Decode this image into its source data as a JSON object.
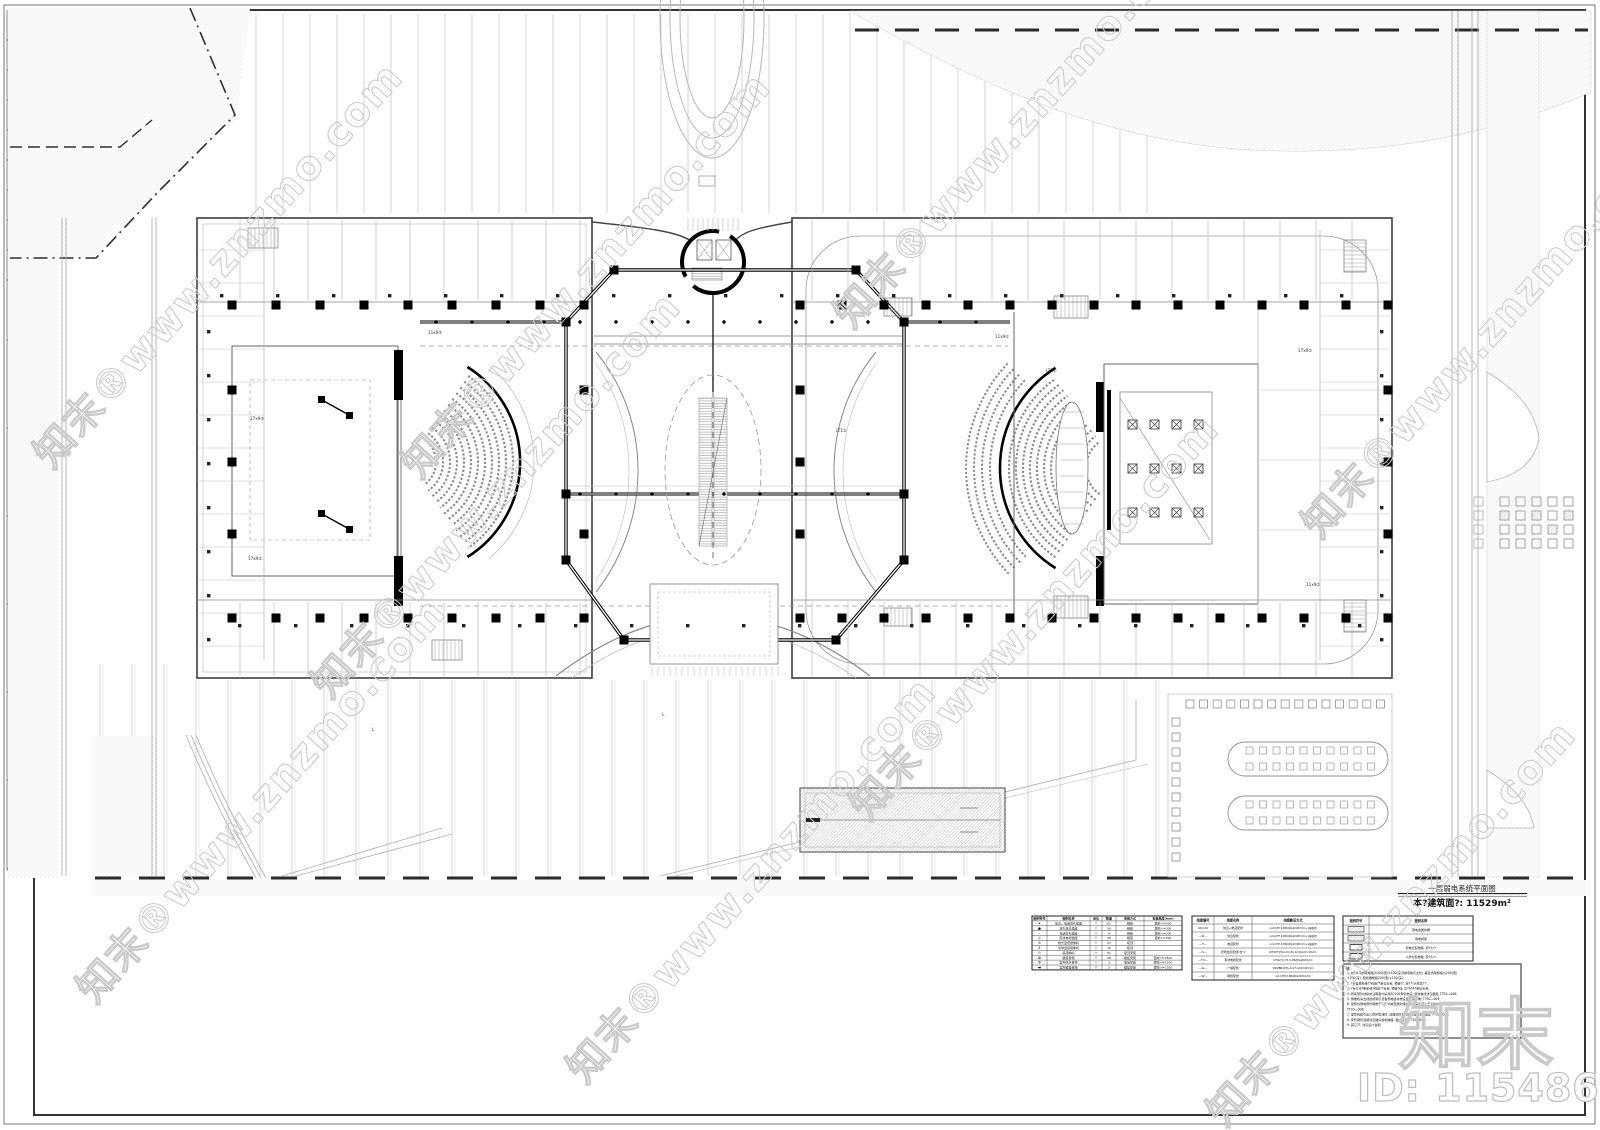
{
  "watermark": {
    "tile_text": "知末®www.znzmo.com",
    "logo_text": "知末",
    "id_text": "ID: 1154862728",
    "color": "#c9c9c9"
  },
  "titleblock": {
    "title": "一层弱电系统平面图",
    "area_label": "本?建筑面?: 11529m²"
  },
  "legend_table": {
    "headers": [
      "图例符号",
      "图例名称",
      "单位",
      "数量",
      "安装方式",
      "安装高度(mm)"
    ],
    "rows": [
      {
        "sym": "✦",
        "name": "信息、电话双孔插座",
        "unit": "个",
        "qty": "61",
        "mount": "暗装",
        "height": "距地 H=300"
      },
      {
        "sym": "●",
        "name": "双孔信息插座",
        "unit": "个",
        "qty": "56",
        "mount": "暗装",
        "height": "距地 H=300"
      },
      {
        "sym": "·",
        "name": "电话双孔插座",
        "unit": "个",
        "qty": "4",
        "mount": "暗装",
        "height": "距地 H=300"
      },
      {
        "sym": "◎",
        "name": "有线电视插座",
        "unit": "个",
        "qty": "28",
        "mount": "暗装",
        "height": "距地 H=300"
      },
      {
        "sym": "⊘",
        "name": "枪式监控摄像机",
        "unit": "个",
        "qty": "21",
        "mount": "吸顶",
        "height": ""
      },
      {
        "sym": "♁",
        "name": "半球监控摄像机",
        "unit": "个",
        "qty": "10",
        "mount": "吸顶",
        "height": ""
      },
      {
        "sym": "⊙",
        "name": "吸顶喇叭",
        "unit": "个",
        "qty": "51",
        "mount": "吸顶安装",
        "height": ""
      },
      {
        "sym": "⊠",
        "name": "壁挂音箱",
        "unit": "个",
        "qty": "28",
        "mount": "壁挂安装",
        "height": "距地 H=2500"
      },
      {
        "sym": "Φ",
        "name": "室外防水音柱",
        "unit": "个",
        "qty": "3",
        "mount": "落地安装",
        "height": "距地 H=1500"
      },
      {
        "sym": "▬",
        "name": "室外壁挂音箱",
        "unit": "个",
        "qty": "3",
        "mount": "壁挂安装",
        "height": "距地 H=1300"
      }
    ]
  },
  "cable_table": {
    "headers": [
      "线缆编号",
      "线缆名称",
      "线缆敷设方式"
    ],
    "rows": [
      [
        "40×20",
        "信息+电话配线",
        "nx2(UTP 6-MR/JDG20)WC/CC+1根备用"
      ],
      [
        "—D—",
        "信息配线",
        "nx1(UTP 6-MR/JDG20)WC/CC+1根备用"
      ],
      [
        "—T—",
        "电话配线",
        "nx1(UTP 6-MR/JDG20)WC/CC+1根备用"
      ],
      [
        "—S—",
        "安防监控配线(含?)",
        "WTWTT(HCAAY2-50-12 JDG20) WC/CC"
      ],
      [
        "—TV—",
        "有线电视配线",
        "SYWV(Y)-75-5-MR/JDG20WC/CC"
      ],
      [
        "—G—",
        "广播配线",
        "WDZBN-RYJS-2x1.5-SC20/WC/CC"
      ],
      [
        "—W—",
        "网络配线",
        "nx1(UTP 6-MR/JDG20)WC/CC"
      ]
    ]
  },
  "box_table": {
    "headers": [
      "图例符号",
      "图例名称"
    ],
    "rows": [
      [
        "▨▨",
        "弱电金属线槽"
      ],
      [
        "▤▤",
        "弱电桥架"
      ],
      [
        "▭",
        "弱电分配电箱, 安?大??"
      ],
      [
        "▭",
        "人防分配电箱, 安?大??"
      ]
    ]
  },
  "notes": {
    "label": "注:",
    "lines": [
      "1. 线?水平桥架规格为300(宽)×100(深)(除特殊标注外), 垂直桥架规格为200(宽)",
      "   ×100(深), 配线槽规格200(宽)×150(深);",
      "2. ?台自控系统??线由??单位负责, 预留??, 安???大样见?? ;",
      "3. ?台灯光?制系统?线由??负责, 预留?线, 见?A?A?单位负责;",
      "4. 所有穿管线缆未注明者均采用SC100穿管敷设, 具体做法详见图集 TT30—006;",
      "5. 弱电机房出线经桥架引至各弱电竖井敷设至相关末端, TT30—009;",
      "6. 建筑内弱电穿管暗敷于?土?内或垫层时保护管埋深不应小于15mm, 详见图集",
      "   TT30—006;",
      "7. 穿管线缆引出入防护区域时, 应做好防护密闭处理, 详见图集 TT30—00?;",
      "8. 穿管钢管连接处应做好接地跨接, 做法详见 TT30—009;",
      "9. 其它??, 详见设计说明."
    ]
  },
  "plan": {
    "labels": [
      {
        "t": "11x9②",
        "x": 428,
        "y": 334
      },
      {
        "t": "17x9②",
        "x": 250,
        "y": 420
      },
      {
        "t": "11x9①",
        "x": 995,
        "y": 338
      },
      {
        "t": "17x9①",
        "x": 1298,
        "y": 352
      },
      {
        "t": "LT3①",
        "x": 1046,
        "y": 372
      },
      {
        "t": "LT1①",
        "x": 836,
        "y": 432
      },
      {
        "t": "11x9②",
        "x": 1306,
        "y": 586
      },
      {
        "t": "17x9②",
        "x": 248,
        "y": 560
      },
      {
        "t": "L",
        "x": 372,
        "y": 731
      },
      {
        "t": "L",
        "x": 662,
        "y": 716
      }
    ]
  }
}
